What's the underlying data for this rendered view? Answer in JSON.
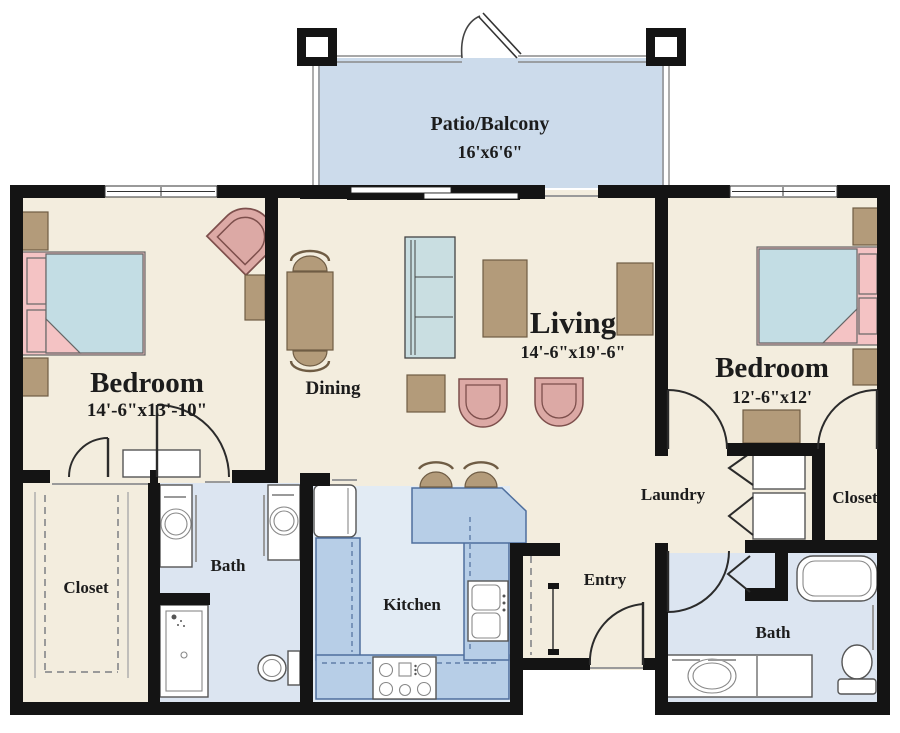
{
  "type": "apartment-floor-plan",
  "rooms": {
    "patio": {
      "label": "Patio/Balcony",
      "dims": "16'x6'6\""
    },
    "bedroom_left": {
      "label": "Bedroom",
      "dims": "14'-6\"x13'-10\""
    },
    "dining": {
      "label": "Dining"
    },
    "living": {
      "label": "Living",
      "dims": "14'-6\"x19'-6\""
    },
    "bedroom_right": {
      "label": "Bedroom",
      "dims": "12'-6\"x12'"
    },
    "laundry": {
      "label": "Laundry"
    },
    "closet_right": {
      "label": "Closet"
    },
    "closet_left": {
      "label": "Closet"
    },
    "bath_left": {
      "label": "Bath"
    },
    "kitchen": {
      "label": "Kitchen"
    },
    "entry": {
      "label": "Entry"
    },
    "bath_right": {
      "label": "Bath"
    }
  },
  "colors": {
    "wall": "#141414",
    "floor": "#f3edde",
    "patio_floor": "#ccdbeb",
    "wet_floor": "#dce5f1",
    "kitchen_floor": "#e2ebf4",
    "counter_blue": "#b7cee7",
    "counter_edge": "#4f6f9d",
    "furniture_brown": "#b39b7a",
    "bed_pink": "#f4c3c4",
    "chair_pink": "#dca9a5",
    "duvet_blue": "#c3dde4",
    "fixture_white": "#ffffff",
    "text": "#1c1c1c"
  }
}
